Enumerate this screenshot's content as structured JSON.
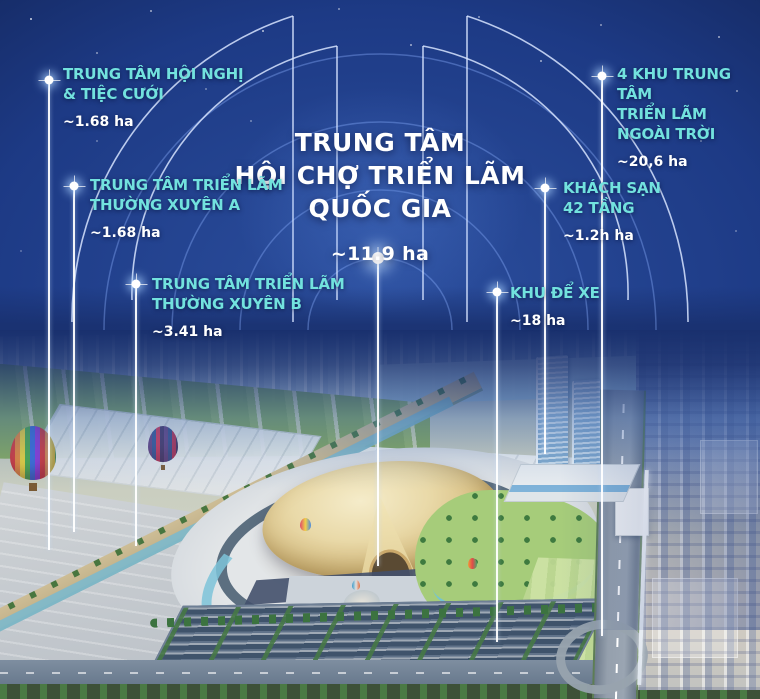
{
  "poster": {
    "title": {
      "lines": [
        "TRUNG TÂM",
        "HỘI CHỢ TRIỂN LÃM",
        "QUỐC GIA"
      ],
      "area": "~11.9 ha"
    },
    "labels": [
      {
        "id": "hoi-nghi-tiec-cuoi",
        "lines": [
          "TRUNG TÂM HỘI NGHỊ",
          "& TIỆC CƯỚI"
        ],
        "area": "~1.68 ha"
      },
      {
        "id": "trien-lam-thuong-xuyen-a",
        "lines": [
          "TRUNG TÂM TRIỂN LÃM",
          "THƯỜNG XUYÊN A"
        ],
        "area": "~1.68 ha"
      },
      {
        "id": "trien-lam-thuong-xuyen-b",
        "lines": [
          "TRUNG TÂM TRIỂN LÃM",
          "THƯỜNG XUYÊN B"
        ],
        "area": "~3.41 ha"
      },
      {
        "id": "khu-de-xe",
        "lines": [
          "KHU ĐỂ XE"
        ],
        "area": "~18 ha"
      },
      {
        "id": "khach-san-42-tang",
        "lines": [
          "KHÁCH SẠN",
          "42 TẦNG"
        ],
        "area": "~1.2h ha"
      },
      {
        "id": "4-khu-trien-lam-ngoai-troi",
        "lines": [
          "4 KHU TRUNG TÂM",
          "TRIỂN LÃM",
          "NGOÀI TRỜI"
        ],
        "area": "~20,6 ha"
      }
    ],
    "colors": {
      "accent": "#72e2de",
      "text": "#ffffff"
    }
  }
}
